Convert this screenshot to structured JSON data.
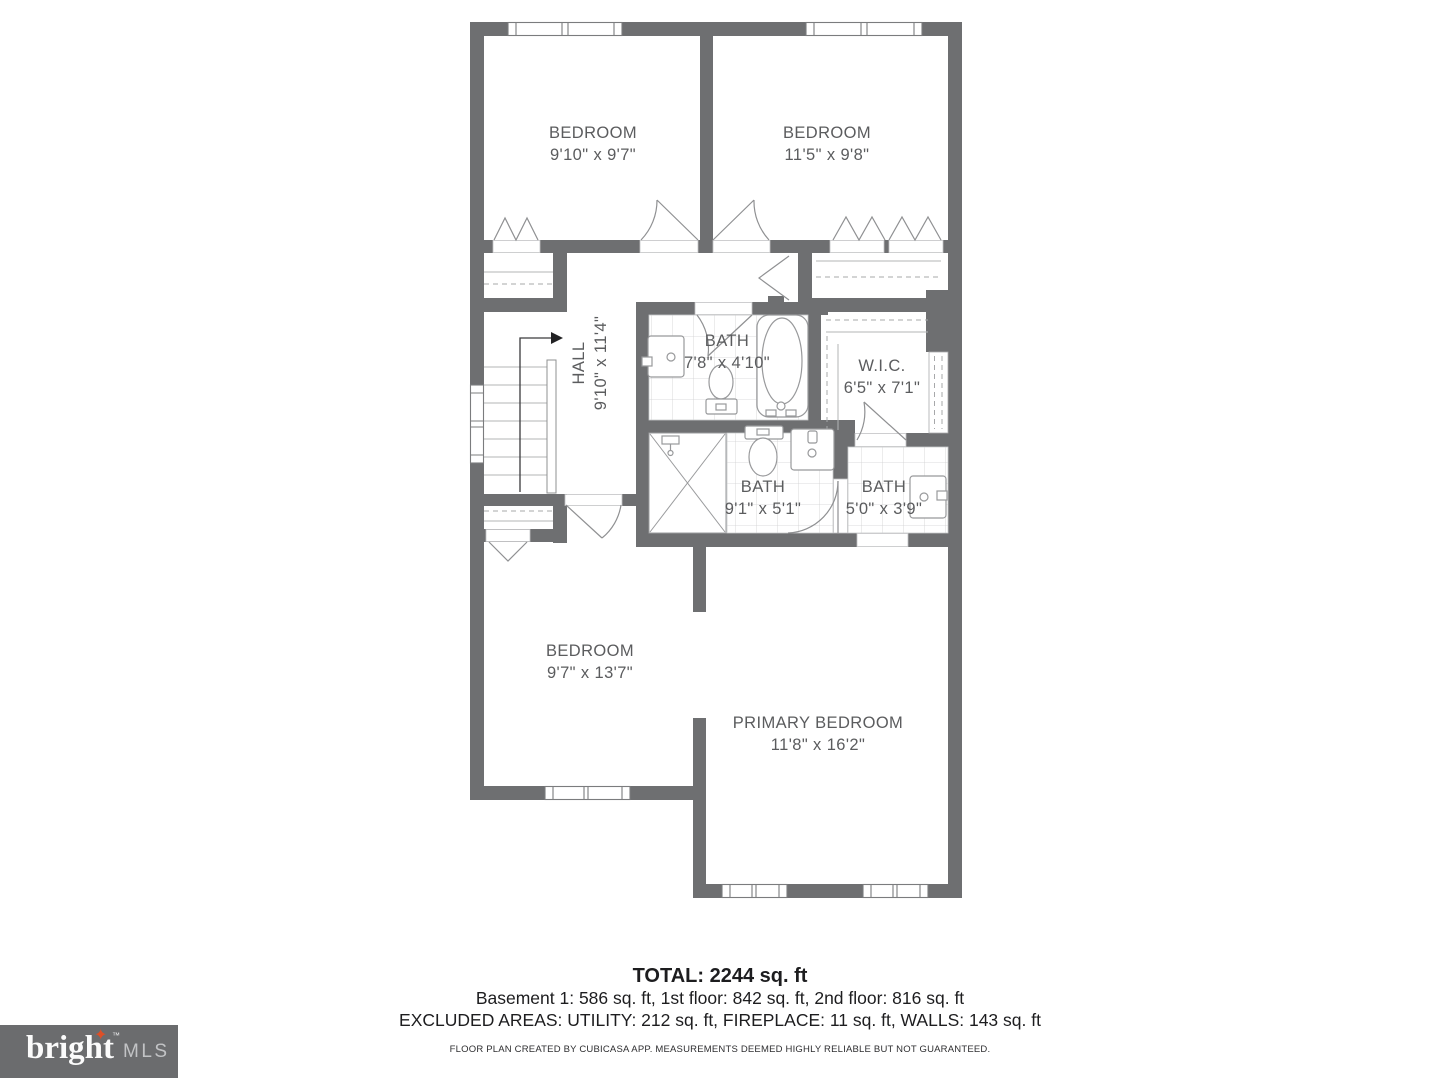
{
  "plan": {
    "rooms": {
      "bedroom1": {
        "label": "BEDROOM",
        "dims": "9'10\" x 9'7\""
      },
      "bedroom2": {
        "label": "BEDROOM",
        "dims": "11'5\" x 9'8\""
      },
      "hall": {
        "label": "HALL",
        "dims": "9'10\" x 11'4\""
      },
      "bath1": {
        "label": "BATH",
        "dims": "7'8\" x 4'10\""
      },
      "wic": {
        "label": "W.I.C.",
        "dims": "6'5\" x 7'1\""
      },
      "bath2": {
        "label": "BATH",
        "dims": "9'1\" x 5'1\""
      },
      "bath3": {
        "label": "BATH",
        "dims": "5'0\" x 3'9\""
      },
      "bedroom3": {
        "label": "BEDROOM",
        "dims": "9'7\" x 13'7\""
      },
      "primary": {
        "label": "PRIMARY BEDROOM",
        "dims": "11'8\" x 16'2\""
      }
    }
  },
  "summary": {
    "total": "TOTAL: 2244 sq. ft",
    "floors": "Basement 1: 586 sq. ft, 1st floor: 842 sq. ft, 2nd floor: 816 sq. ft",
    "excluded": "EXCLUDED AREAS: UTILITY: 212 sq. ft, FIREPLACE: 11 sq. ft, WALLS: 143 sq. ft",
    "disclaimer": "FLOOR PLAN CREATED BY CUBICASA APP. MEASUREMENTS DEEMED HIGHLY RELIABLE BUT NOT GUARANTEED."
  },
  "logo": {
    "brand": "bright",
    "star": "✦",
    "tm": "™",
    "suffix": "MLS"
  },
  "colors": {
    "wall": "#6e6f71",
    "accent": "#dd4f27",
    "label": "#5b5c5e"
  }
}
